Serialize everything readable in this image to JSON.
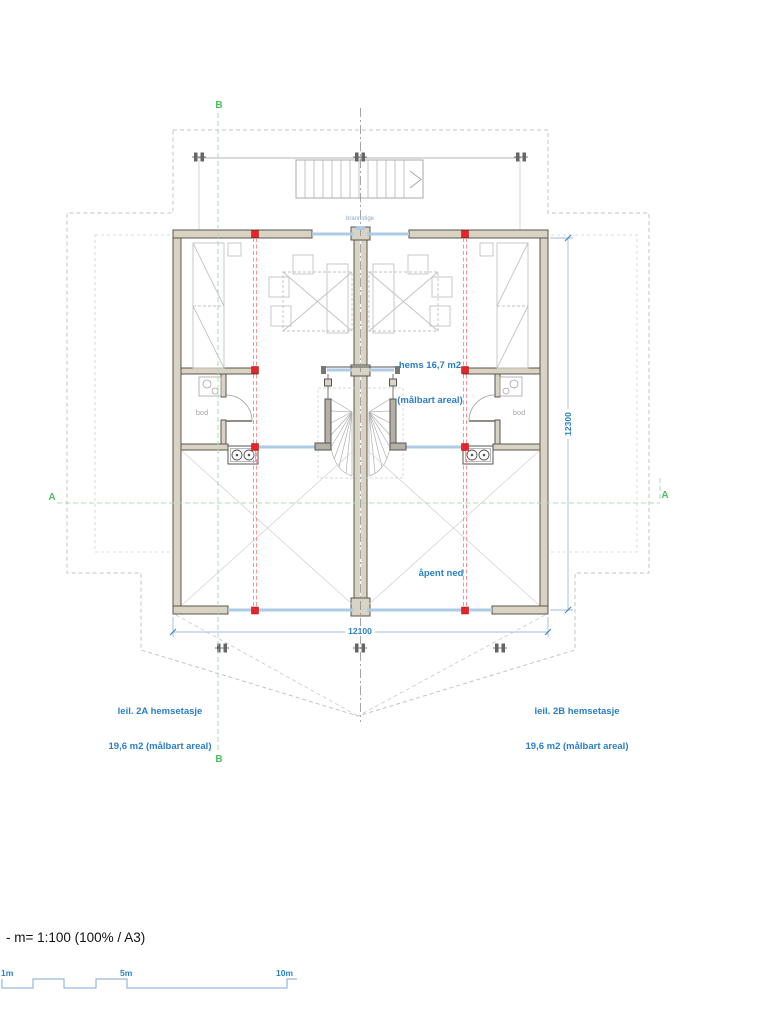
{
  "drawing": {
    "scale_note": "- m= 1:100 (100% / A3)",
    "labels": {
      "hems_line1": "hems 16,7 m2",
      "hems_line2": "(målbart areal)",
      "apent_ned": "åpent ned",
      "leil_2a_line1": "leil. 2A hemsetasje",
      "leil_2a_line2": "19,6 m2 (målbart areal)",
      "leil_2b_line1": "leil. 2B hemsetasje",
      "leil_2b_line2": "19,6 m2 (målbart areal)",
      "bod_left": "bod",
      "bod_right": "bod",
      "brannstige": "brannstige"
    },
    "dimensions": {
      "overall_width_mm": "12100",
      "overall_depth_mm": "12300"
    },
    "section_markers": {
      "b_top": "B",
      "b_bottom": "B",
      "a_left": "A",
      "a_right": "A"
    },
    "scale_bar": {
      "tick_1m": "1m",
      "tick_5m": "5m",
      "tick_10m": "10m"
    },
    "colors": {
      "label_blue": "#2a7fc9",
      "dimension_blue": "#9dbede",
      "glazing_blue": "#aecbe4",
      "section_green": "#4bbf5f",
      "structure_red": "#e8242a",
      "wall_fill": "#d8d3c3"
    }
  }
}
